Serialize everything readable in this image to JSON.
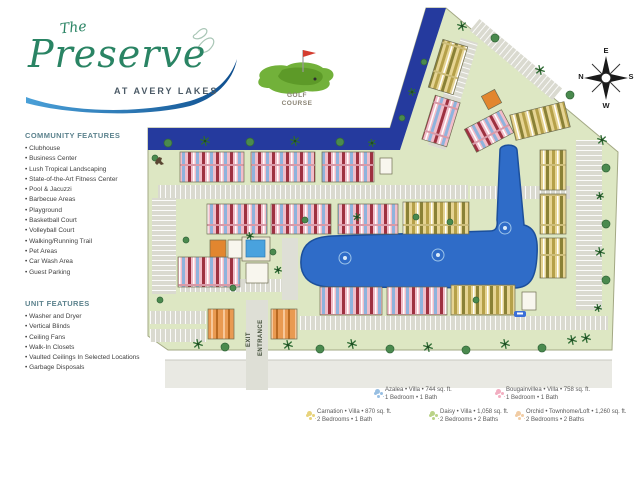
{
  "logo": {
    "the": "The",
    "name": "Preserve",
    "subtitle": "AT AVERY LAKES"
  },
  "community_features": {
    "title": "COMMUNITY FEATURES",
    "items": [
      "Clubhouse",
      "Business Center",
      "Lush Tropical Landscaping",
      "State-of-the-Art Fitness Center",
      "Pool & Jacuzzi",
      "Barbecue Areas",
      "Playground",
      "Basketball Court",
      "Volleyball Court",
      "Walking/Running Trail",
      "Pet Areas",
      "Car Wash Area",
      "Guest Parking"
    ]
  },
  "unit_features": {
    "title": "UNIT FEATURES",
    "items": [
      "Washer and Dryer",
      "Vertical Blinds",
      "Ceiling Fans",
      "Walk-In Closets",
      "Vaulted Ceilings In Selected Locations",
      "Garbage Disposals"
    ]
  },
  "map": {
    "golf_line1": "GOLF",
    "golf_line2": "COURSE",
    "exit": "EXIT",
    "entrance": "ENTRANCE",
    "compass": {
      "top": "E",
      "right": "S",
      "bottom": "W",
      "left": "N"
    }
  },
  "legend": [
    {
      "line1": "Azalea • Villa • 744 sq. ft.",
      "line2": "1 Bedroom • 1 Bath",
      "color": "#7fb0dc"
    },
    {
      "line1": "Bougainvillea • Villa • 758 sq. ft.",
      "line2": "1 Bedroom • 1 Bath",
      "color": "#f09ab2"
    },
    {
      "line1": "Carnation • Villa • 870 sq. ft.",
      "line2": "2 Bedrooms • 1 Bath",
      "color": "#e3c95c"
    },
    {
      "line1": "Daisy • Villa • 1,058 sq. ft.",
      "line2": "2 Bedrooms • 2 Baths",
      "color": "#a9c96a"
    },
    {
      "line1": "Orchid • Townhome/Loft • 1,260 sq. ft.",
      "line2": "2 Bedrooms • 2 Baths",
      "color": "#eec08e"
    }
  ],
  "map_features": {
    "water_color": "#253a9e",
    "lake_color": "#2f6cc8",
    "grass_color": "#dde7c3",
    "buildings": [
      {
        "x": 180,
        "y": 152,
        "w": 64,
        "h": 30,
        "r": 0,
        "t": "pk"
      },
      {
        "x": 251,
        "y": 152,
        "w": 64,
        "h": 30,
        "r": 0,
        "t": "pk"
      },
      {
        "x": 322,
        "y": 152,
        "w": 52,
        "h": 30,
        "r": 0,
        "t": "pk"
      },
      {
        "x": 380,
        "y": 158,
        "w": 12,
        "h": 16,
        "r": 0,
        "t": "am"
      },
      {
        "x": 207,
        "y": 204,
        "w": 60,
        "h": 30,
        "r": 0,
        "t": "pk"
      },
      {
        "x": 271,
        "y": 204,
        "w": 60,
        "h": 30,
        "r": 0,
        "t": "pk"
      },
      {
        "x": 338,
        "y": 204,
        "w": 60,
        "h": 30,
        "r": 0,
        "t": "pk"
      },
      {
        "x": 403,
        "y": 202,
        "w": 66,
        "h": 32,
        "r": 0,
        "t": "yl"
      },
      {
        "x": 178,
        "y": 257,
        "w": 62,
        "h": 30,
        "r": 0,
        "t": "pk"
      },
      {
        "x": 320,
        "y": 287,
        "w": 62,
        "h": 28,
        "r": 0,
        "t": "pk"
      },
      {
        "x": 387,
        "y": 287,
        "w": 60,
        "h": 28,
        "r": 0,
        "t": "pk"
      },
      {
        "x": 451,
        "y": 285,
        "w": 64,
        "h": 30,
        "r": 0,
        "t": "yl"
      },
      {
        "x": 208,
        "y": 309,
        "w": 26,
        "h": 30,
        "r": 0,
        "t": "og"
      },
      {
        "x": 271,
        "y": 309,
        "w": 26,
        "h": 30,
        "r": 0,
        "t": "og"
      },
      {
        "x": 435,
        "y": 42,
        "w": 26,
        "h": 50,
        "r": 17,
        "t": "yl"
      },
      {
        "x": 428,
        "y": 98,
        "w": 26,
        "h": 46,
        "r": 17,
        "t": "pk"
      },
      {
        "x": 468,
        "y": 118,
        "w": 42,
        "h": 26,
        "r": -28,
        "t": "pk"
      },
      {
        "x": 484,
        "y": 92,
        "w": 15,
        "h": 15,
        "r": -28,
        "t": "ct"
      },
      {
        "x": 512,
        "y": 108,
        "w": 56,
        "h": 26,
        "r": -14,
        "t": "yl"
      },
      {
        "x": 540,
        "y": 150,
        "w": 26,
        "h": 40,
        "r": 0,
        "t": "yl"
      },
      {
        "x": 540,
        "y": 194,
        "w": 26,
        "h": 40,
        "r": 0,
        "t": "yl"
      },
      {
        "x": 540,
        "y": 238,
        "w": 26,
        "h": 40,
        "r": 0,
        "t": "yl"
      },
      {
        "x": 522,
        "y": 292,
        "w": 14,
        "h": 18,
        "r": 0,
        "t": "am"
      },
      {
        "x": 210,
        "y": 240,
        "w": 16,
        "h": 17,
        "r": 0,
        "t": "ct"
      },
      {
        "x": 228,
        "y": 240,
        "w": 14,
        "h": 18,
        "r": 0,
        "t": "am"
      },
      {
        "x": 242,
        "y": 237,
        "w": 28,
        "h": 24,
        "r": 0,
        "t": "dk"
      },
      {
        "x": 246,
        "y": 240,
        "w": 19,
        "h": 17,
        "r": 0,
        "t": "pl"
      },
      {
        "x": 246,
        "y": 263,
        "w": 22,
        "h": 20,
        "r": 0,
        "t": "am"
      }
    ],
    "parking": [
      {
        "x": 158,
        "y": 185,
        "w": 310,
        "h": 14
      },
      {
        "x": 152,
        "y": 198,
        "w": 24,
        "h": 96,
        "v": true
      },
      {
        "x": 180,
        "y": 279,
        "w": 112,
        "h": 13
      },
      {
        "x": 150,
        "y": 311,
        "w": 56,
        "h": 13
      },
      {
        "x": 150,
        "y": 329,
        "w": 56,
        "h": 13
      },
      {
        "x": 300,
        "y": 316,
        "w": 308,
        "h": 14
      },
      {
        "x": 576,
        "y": 140,
        "w": 26,
        "h": 170,
        "v": true
      },
      {
        "x": 470,
        "y": 186,
        "w": 100,
        "h": 13
      },
      {
        "x": 444,
        "y": 38,
        "w": 18,
        "h": 112,
        "r": 17,
        "v": true
      },
      {
        "x": 462,
        "y": 52,
        "w": 108,
        "h": 15,
        "r": 40
      },
      {
        "x": 246,
        "y": 300,
        "w": 22,
        "h": 90,
        "plain": true
      },
      {
        "x": 282,
        "y": 238,
        "w": 16,
        "h": 62,
        "plain": true
      }
    ],
    "trees": [
      {
        "x": 168,
        "y": 143,
        "k": "b",
        "s": 4
      },
      {
        "x": 205,
        "y": 141,
        "k": "p",
        "s": 5
      },
      {
        "x": 250,
        "y": 142,
        "k": "b",
        "s": 4
      },
      {
        "x": 295,
        "y": 141,
        "k": "p",
        "s": 5
      },
      {
        "x": 340,
        "y": 142,
        "k": "b",
        "s": 4
      },
      {
        "x": 372,
        "y": 143,
        "k": "p",
        "s": 4
      },
      {
        "x": 402,
        "y": 118,
        "k": "b",
        "s": 3
      },
      {
        "x": 412,
        "y": 92,
        "k": "p",
        "s": 4
      },
      {
        "x": 424,
        "y": 62,
        "k": "b",
        "s": 3
      },
      {
        "x": 462,
        "y": 26,
        "k": "p",
        "s": 5
      },
      {
        "x": 495,
        "y": 38,
        "k": "b",
        "s": 4
      },
      {
        "x": 540,
        "y": 70,
        "k": "p",
        "s": 5
      },
      {
        "x": 570,
        "y": 95,
        "k": "b",
        "s": 4
      },
      {
        "x": 602,
        "y": 140,
        "k": "p",
        "s": 5
      },
      {
        "x": 606,
        "y": 168,
        "k": "b",
        "s": 4
      },
      {
        "x": 600,
        "y": 196,
        "k": "p",
        "s": 4
      },
      {
        "x": 606,
        "y": 224,
        "k": "b",
        "s": 4
      },
      {
        "x": 600,
        "y": 252,
        "k": "p",
        "s": 5
      },
      {
        "x": 606,
        "y": 280,
        "k": "b",
        "s": 4
      },
      {
        "x": 598,
        "y": 308,
        "k": "p",
        "s": 4
      },
      {
        "x": 586,
        "y": 338,
        "k": "p",
        "s": 5
      },
      {
        "x": 198,
        "y": 344,
        "k": "p",
        "s": 5
      },
      {
        "x": 225,
        "y": 347,
        "k": "b",
        "s": 4
      },
      {
        "x": 288,
        "y": 345,
        "k": "p",
        "s": 5
      },
      {
        "x": 320,
        "y": 349,
        "k": "b",
        "s": 4
      },
      {
        "x": 352,
        "y": 344,
        "k": "p",
        "s": 5
      },
      {
        "x": 390,
        "y": 349,
        "k": "b",
        "s": 4
      },
      {
        "x": 428,
        "y": 347,
        "k": "p",
        "s": 5
      },
      {
        "x": 466,
        "y": 350,
        "k": "b",
        "s": 4
      },
      {
        "x": 505,
        "y": 344,
        "k": "p",
        "s": 5
      },
      {
        "x": 542,
        "y": 348,
        "k": "b",
        "s": 4
      },
      {
        "x": 572,
        "y": 340,
        "k": "p",
        "s": 5
      },
      {
        "x": 250,
        "y": 236,
        "k": "p",
        "s": 4
      },
      {
        "x": 273,
        "y": 252,
        "k": "b",
        "s": 3
      },
      {
        "x": 278,
        "y": 270,
        "k": "p",
        "s": 4
      },
      {
        "x": 233,
        "y": 288,
        "k": "b",
        "s": 3
      },
      {
        "x": 186,
        "y": 240,
        "k": "b",
        "s": 3
      },
      {
        "x": 160,
        "y": 300,
        "k": "b",
        "s": 3
      },
      {
        "x": 305,
        "y": 220,
        "k": "b",
        "s": 3
      },
      {
        "x": 357,
        "y": 217,
        "k": "p",
        "s": 4
      },
      {
        "x": 416,
        "y": 217,
        "k": "b",
        "s": 3
      },
      {
        "x": 450,
        "y": 222,
        "k": "b",
        "s": 3
      },
      {
        "x": 155,
        "y": 158,
        "k": "b",
        "s": 3
      },
      {
        "x": 476,
        "y": 300,
        "k": "b",
        "s": 3
      }
    ],
    "fountains": [
      {
        "x": 345,
        "y": 258
      },
      {
        "x": 438,
        "y": 255
      },
      {
        "x": 505,
        "y": 228
      }
    ]
  }
}
